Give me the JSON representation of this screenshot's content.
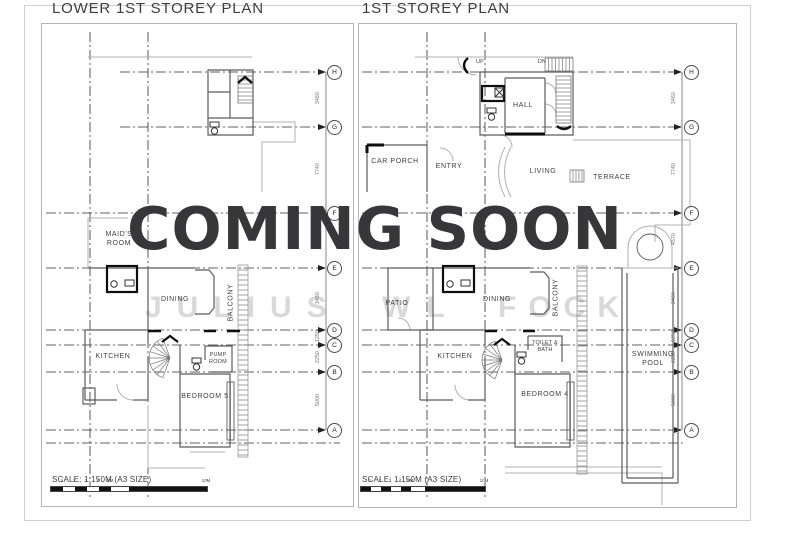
{
  "page": {
    "coming_soon": "COMING SOON",
    "watermark": {
      "part1": "JULIUS",
      "part2": "WL",
      "part3": "FOCK"
    }
  },
  "grid": {
    "letters": [
      "H",
      "G",
      "F",
      "E",
      "D",
      "C",
      "B",
      "A"
    ],
    "dims": [
      "3460",
      "7740",
      "4570",
      "3460",
      "1250",
      "2250",
      "5000"
    ]
  },
  "left_plan": {
    "title": "LOWER 1ST STOREY PLAN",
    "scale_note": "SCALE: 1:150M (A3 SIZE)",
    "rooms": {
      "maids_room": "MAID'S ROOM",
      "dining": "DINING",
      "balcony": "BALCONY",
      "kitchen": "KITCHEN",
      "pump_room": "PUMP ROOM",
      "bedroom5": "BEDROOM 5"
    }
  },
  "right_plan": {
    "title": "1ST STOREY PLAN",
    "scale_note": "SCALE: 1:150M (A3 SIZE)",
    "stairs": {
      "up": "UP",
      "dn": "DN"
    },
    "rooms": {
      "hall": "HALL",
      "car_porch": "CAR PORCH",
      "entry": "ENTRY",
      "living": "LIVING",
      "terrace": "TERRACE",
      "patio": "PATIO",
      "dining": "DINING",
      "balcony": "BALCONY",
      "kitchen": "KITCHEN",
      "toilet_bath": "TOILET & BATH",
      "bedroom4": "BEDROOM 4",
      "swimming_pool": "SWIMMING POOL"
    }
  },
  "scale_bar": {
    "ticks": [
      "1",
      "2",
      "3",
      "4",
      "5M"
    ],
    "end_label": "10M"
  },
  "colors": {
    "coming_soon": "#37373a",
    "line": "#5c5c5c",
    "dark_line": "#0e0e0e",
    "watermark": "#d9d9d9"
  }
}
